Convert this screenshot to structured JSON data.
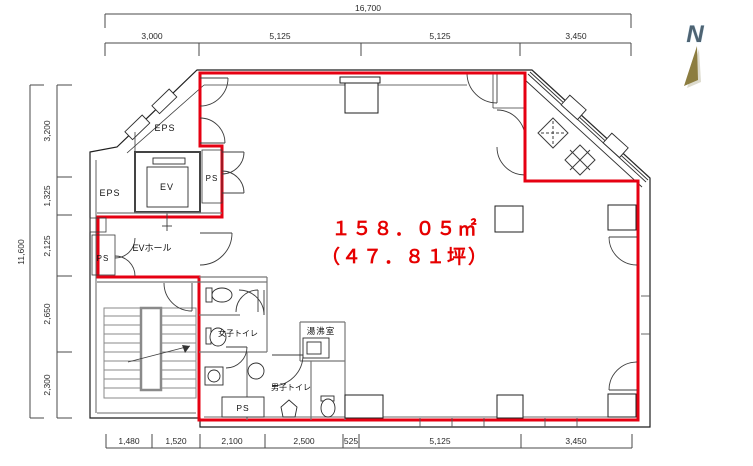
{
  "north": {
    "label": "N"
  },
  "area": {
    "line1": "１５８．０５㎡",
    "line2": "（４７．８１坪）"
  },
  "rooms": {
    "eps_upper": "EPS",
    "eps_left": "EPS",
    "ev": "EV",
    "ev_hall": "EVホール",
    "ps_upper": "PS",
    "ps_left": "PS",
    "ps_bottom": "PS",
    "womens_toilet": "女子トイレ",
    "mens_toilet": "男子トイレ",
    "kitchenette": "湯沸室"
  },
  "dimensions": {
    "top": {
      "total": "16,700",
      "segments": [
        "3,000",
        "5,125",
        "5,125",
        "3,450"
      ]
    },
    "left": {
      "total": "11,600",
      "segments": [
        "3,200",
        "1,325",
        "2,125",
        "2,650",
        "2,300"
      ]
    },
    "bottom": {
      "segments": [
        "1,480",
        "1,520",
        "2,100",
        "2,500",
        "525",
        "5,125",
        "3,450"
      ]
    }
  },
  "colors": {
    "boundary": "#e60012",
    "area_text": "#e60000",
    "north_needle": "#8c7d40",
    "north_letter": "#4e6372"
  }
}
